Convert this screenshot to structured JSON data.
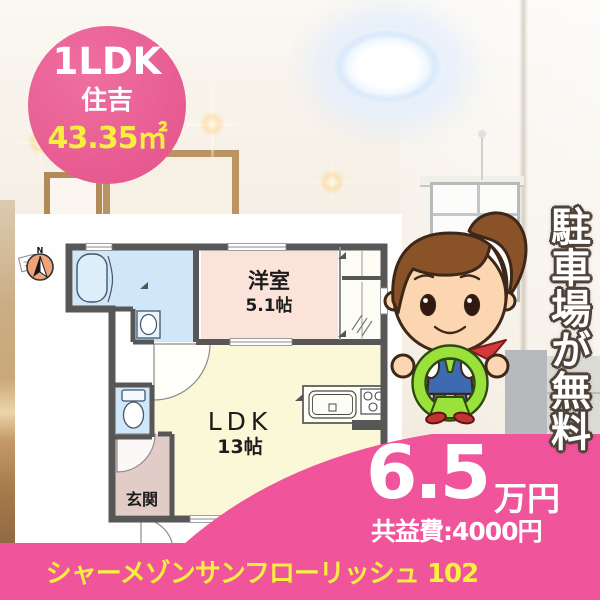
{
  "badge": {
    "layout": "1LDK",
    "location": "住吉",
    "area": "43.35㎡"
  },
  "ribbon": {
    "text": "駐車場が無料"
  },
  "floor_plan": {
    "compass": "N",
    "western_room_label": "洋室",
    "western_room_size": "5.1帖",
    "ldk_label": "LDK",
    "ldk_size": "13帖",
    "entrance_label": "玄関"
  },
  "price": {
    "rent": "6.5",
    "unit": "万円",
    "common_fee": "共益費:4000円"
  },
  "footer": {
    "property_name": "シャーメゾンサンフローリッシュ 102"
  },
  "colors": {
    "main_pink": "#f0549b",
    "badge_pink": "#e75b91",
    "accent_yellow": "#f8ef3f",
    "room_blue": "#cfe7f8",
    "room_pink": "#fbe3da",
    "room_yellow": "#fbf8d7",
    "wall_gray": "#575757",
    "wheel_green": "#9be13c"
  }
}
